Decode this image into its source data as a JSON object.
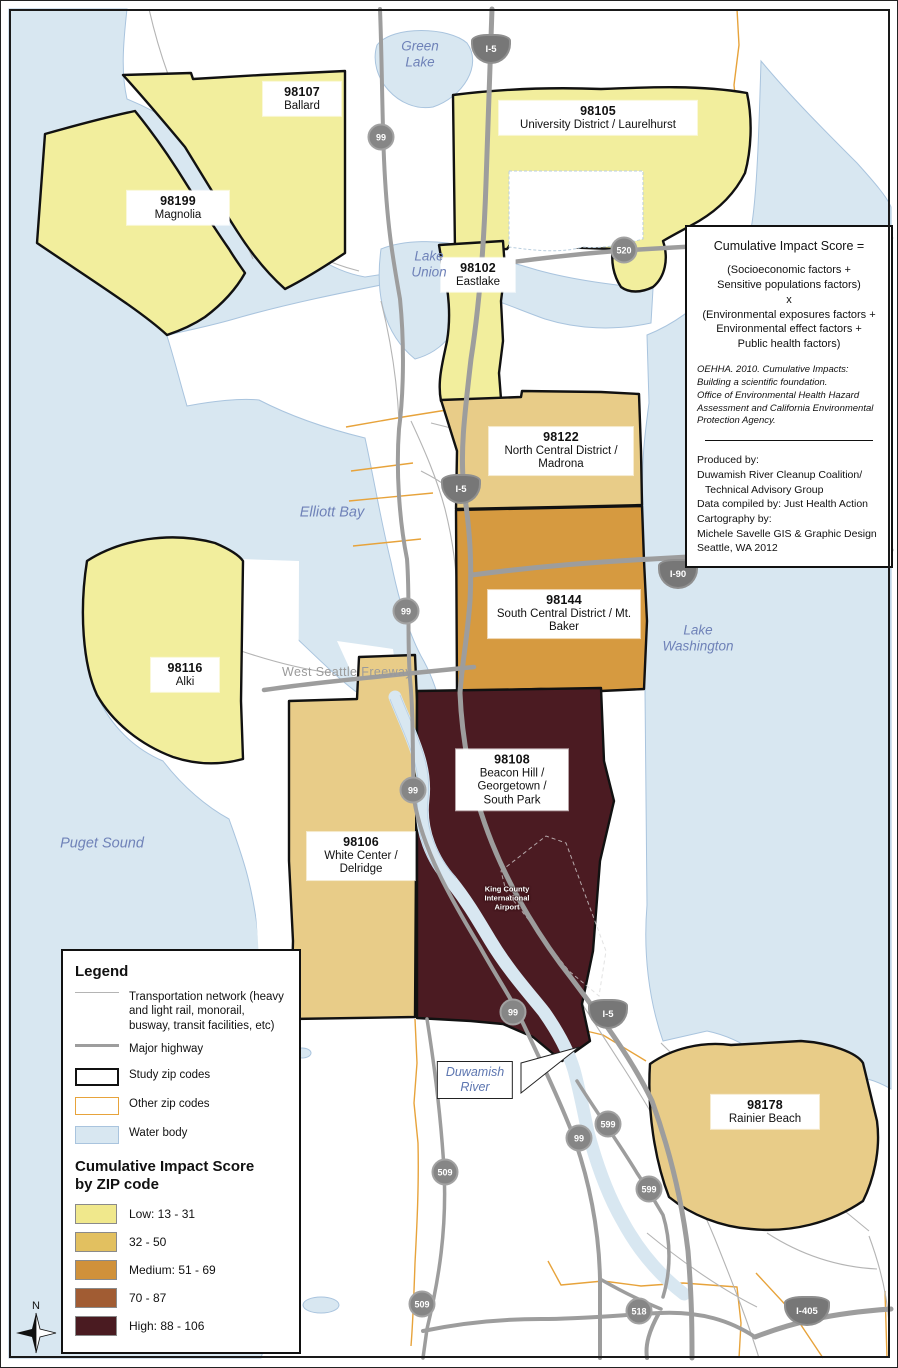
{
  "map": {
    "region": "Seattle, WA",
    "purpose": "Cumulative Impact Score by ZIP code choropleth map"
  },
  "zips": [
    {
      "code": "98107",
      "name": "Ballard",
      "class": "Low: 13 - 31"
    },
    {
      "code": "98105",
      "name": "University District / Laurelhurst",
      "class": "Low: 13 - 31"
    },
    {
      "code": "98199",
      "name": "Magnolia",
      "class": "Low: 13 - 31"
    },
    {
      "code": "98102",
      "name": "Eastlake",
      "class": "Low: 13 - 31"
    },
    {
      "code": "98122",
      "name": "North Central District / Madrona",
      "class": "32 - 50"
    },
    {
      "code": "98144",
      "name": "South Central District / Mt. Baker",
      "class": "Medium: 51 - 69"
    },
    {
      "code": "98116",
      "name": "Alki",
      "class": "Low: 13 - 31"
    },
    {
      "code": "98108",
      "name": "Beacon Hill / Georgetown / South Park",
      "class": "High: 88 - 106"
    },
    {
      "code": "98106",
      "name": "White Center / Delridge",
      "class": "32 - 50"
    },
    {
      "code": "98178",
      "name": "Rainier Beach",
      "class": "32 - 50"
    }
  ],
  "water_labels": [
    {
      "line1": "Green",
      "line2": "Lake"
    },
    {
      "line1": "Lake",
      "line2": "Union"
    },
    {
      "line1": "Elliott Bay",
      "line2": ""
    },
    {
      "line1": "Lake",
      "line2": "Washington"
    },
    {
      "line1": "Puget Sound",
      "line2": ""
    }
  ],
  "river_label": {
    "line1": "Duwamish",
    "line2": "River"
  },
  "road_labels": {
    "freeway": "West Seattle Freeway",
    "airport_line1": "King County",
    "airport_line2": "International",
    "airport_line3": "Airport"
  },
  "shields": [
    {
      "label": "I-5",
      "type": "interstate"
    },
    {
      "label": "99",
      "type": "circle"
    },
    {
      "label": "520",
      "type": "circle"
    },
    {
      "label": "I-5",
      "type": "interstate"
    },
    {
      "label": "I-90",
      "type": "interstate"
    },
    {
      "label": "99",
      "type": "circle"
    },
    {
      "label": "99",
      "type": "circle"
    },
    {
      "label": "99",
      "type": "circle"
    },
    {
      "label": "I-5",
      "type": "interstate"
    },
    {
      "label": "599",
      "type": "circle"
    },
    {
      "label": "99",
      "type": "circle"
    },
    {
      "label": "509",
      "type": "circle"
    },
    {
      "label": "599",
      "type": "circle"
    },
    {
      "label": "509",
      "type": "circle"
    },
    {
      "label": "518",
      "type": "circle"
    },
    {
      "label": "I-405",
      "type": "interstate"
    }
  ],
  "info_box": {
    "title": "Cumulative Impact Score =",
    "formula": [
      "(Socioeconomic factors +",
      "Sensitive populations factors)",
      "x",
      "(Environmental exposures factors +",
      "Environmental effect factors +",
      "Public health factors)"
    ],
    "citation": [
      "OEHHA. 2010. Cumulative Impacts:",
      "Building a scientific foundation.",
      "Office of Environmental Health Hazard",
      "Assessment and California Environmental",
      "Protection Agency."
    ],
    "credits": [
      "Produced by:",
      "Duwamish River Cleanup Coalition/",
      "Technical Advisory Group",
      "Data compiled by: Just Health Action",
      "Cartography by:",
      "Michele Savelle GIS & Graphic Design",
      "Seattle, WA  2012"
    ]
  },
  "legend": {
    "title": "Legend",
    "items": [
      {
        "label": "Transportation network (heavy and light rail, monorail, busway, transit facilities, etc)",
        "swatch": "thin-line"
      },
      {
        "label": "Major highway",
        "swatch": "thick-line"
      },
      {
        "label": "Study zip codes",
        "swatch": "black-outline-box"
      },
      {
        "label": "Other zip codes",
        "swatch": "orange-outline-box"
      },
      {
        "label": "Water body",
        "swatch": "water-fill-box"
      }
    ],
    "score_title_line1": "Cumulative Impact Score",
    "score_title_line2": "by ZIP code",
    "classes": [
      {
        "label": "Low: 13 - 31",
        "color": "#f0e88c"
      },
      {
        "label": "32 - 50",
        "color": "#e2c060"
      },
      {
        "label": "Medium: 51 - 69",
        "color": "#d0913a"
      },
      {
        "label": "70 - 87",
        "color": "#a15c33"
      },
      {
        "label": "High: 88 - 106",
        "color": "#4a1b21"
      }
    ]
  },
  "scalebar": {
    "labels": [
      "0",
      "0.5",
      "1",
      "2 Miles"
    ]
  },
  "north_label": "N",
  "colors": {
    "water": "#d8e7f1",
    "water_outline": "#a9c4de",
    "low": "#f2ee9d",
    "class2": "#e8cc88",
    "medium": "#d69a40",
    "high": "#4b1b22",
    "other_zip_outline": "#e7a33b",
    "study_zip_outline": "#111111",
    "road_thin": "#b4b4b4",
    "road_thick": "#9d9d9d",
    "water_text": "#6f82b8"
  }
}
